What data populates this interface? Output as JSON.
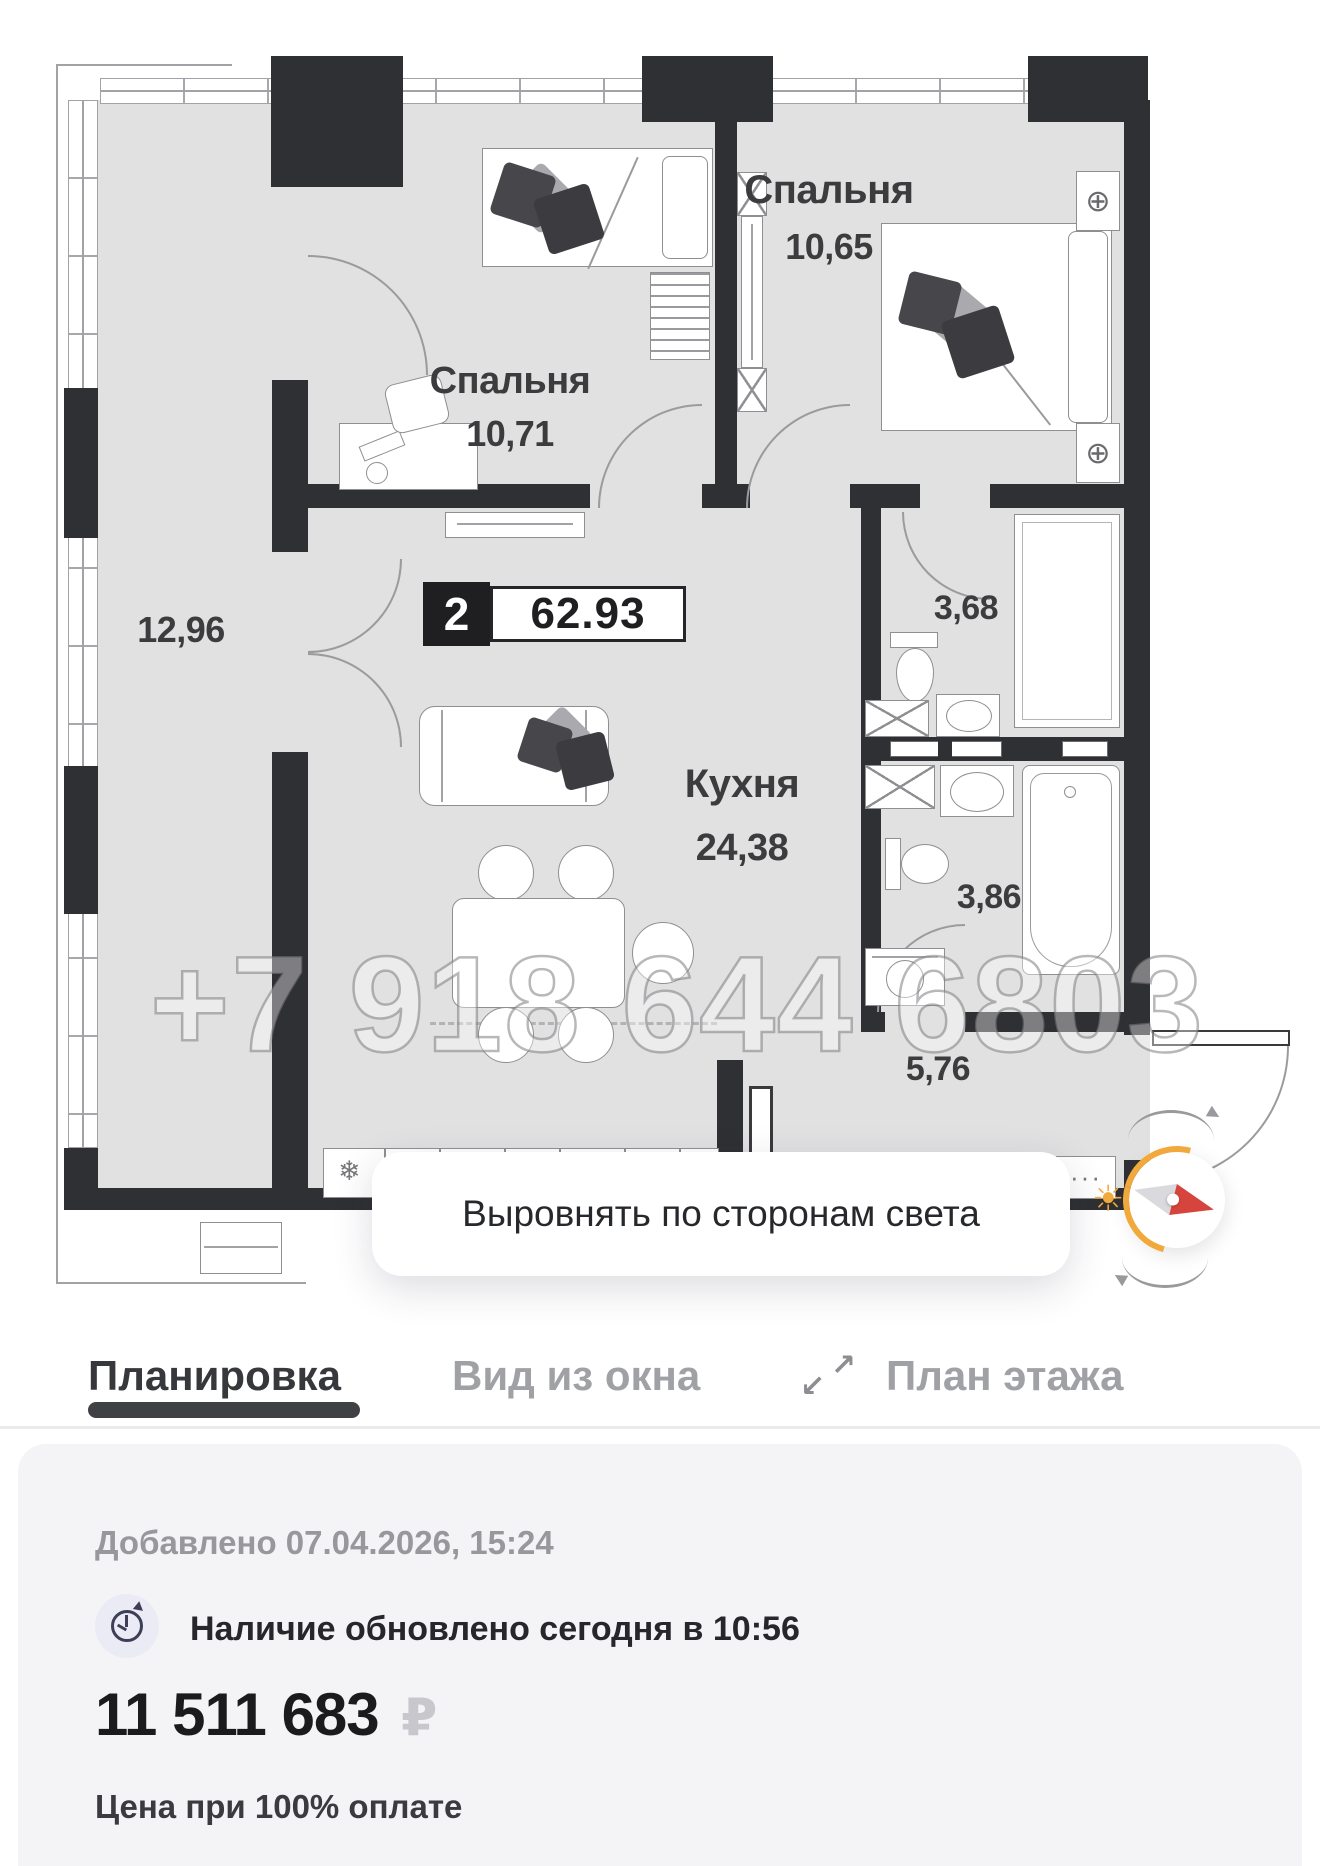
{
  "colors": {
    "accent_orange": "#F2A93B",
    "needle_red": "#D6453D",
    "wall": "#2F3033",
    "tab_active": "#36383B",
    "tab_inactive": "#9FA1A5",
    "card_bg": "#F4F4F6"
  },
  "plan": {
    "badge": {
      "rooms": "2",
      "area": "62.93"
    },
    "rooms": [
      {
        "name": "Спальня",
        "area": "10,71"
      },
      {
        "name": "Спальня",
        "area": "10,65"
      },
      {
        "name": "",
        "area": "12,96"
      },
      {
        "name": "Кухня",
        "area": "24,38"
      },
      {
        "name": "",
        "area": "3,68"
      },
      {
        "name": "",
        "area": "3,86"
      },
      {
        "name": "",
        "area": "5,76"
      }
    ],
    "watermark": "+7 918 644 6803",
    "icons": {
      "snowflake": "❄",
      "wardrobe": "⊕",
      "dots": "···",
      "sun": "☀"
    }
  },
  "overlay": {
    "align_button": "Выровнять по сторонам света"
  },
  "tabs": {
    "planirovka": "Планировка",
    "vid_iz_okna": "Вид из окна",
    "plan_etazha": "План этажа",
    "expand_up": "↗",
    "expand_down": "↙"
  },
  "card": {
    "added": "Добавлено 07.04.2026, 15:24",
    "availability": "Наличие обновлено сегодня в 10:56",
    "price": "11 511 683",
    "currency": "₽",
    "price_note": "Цена при 100% оплате"
  }
}
